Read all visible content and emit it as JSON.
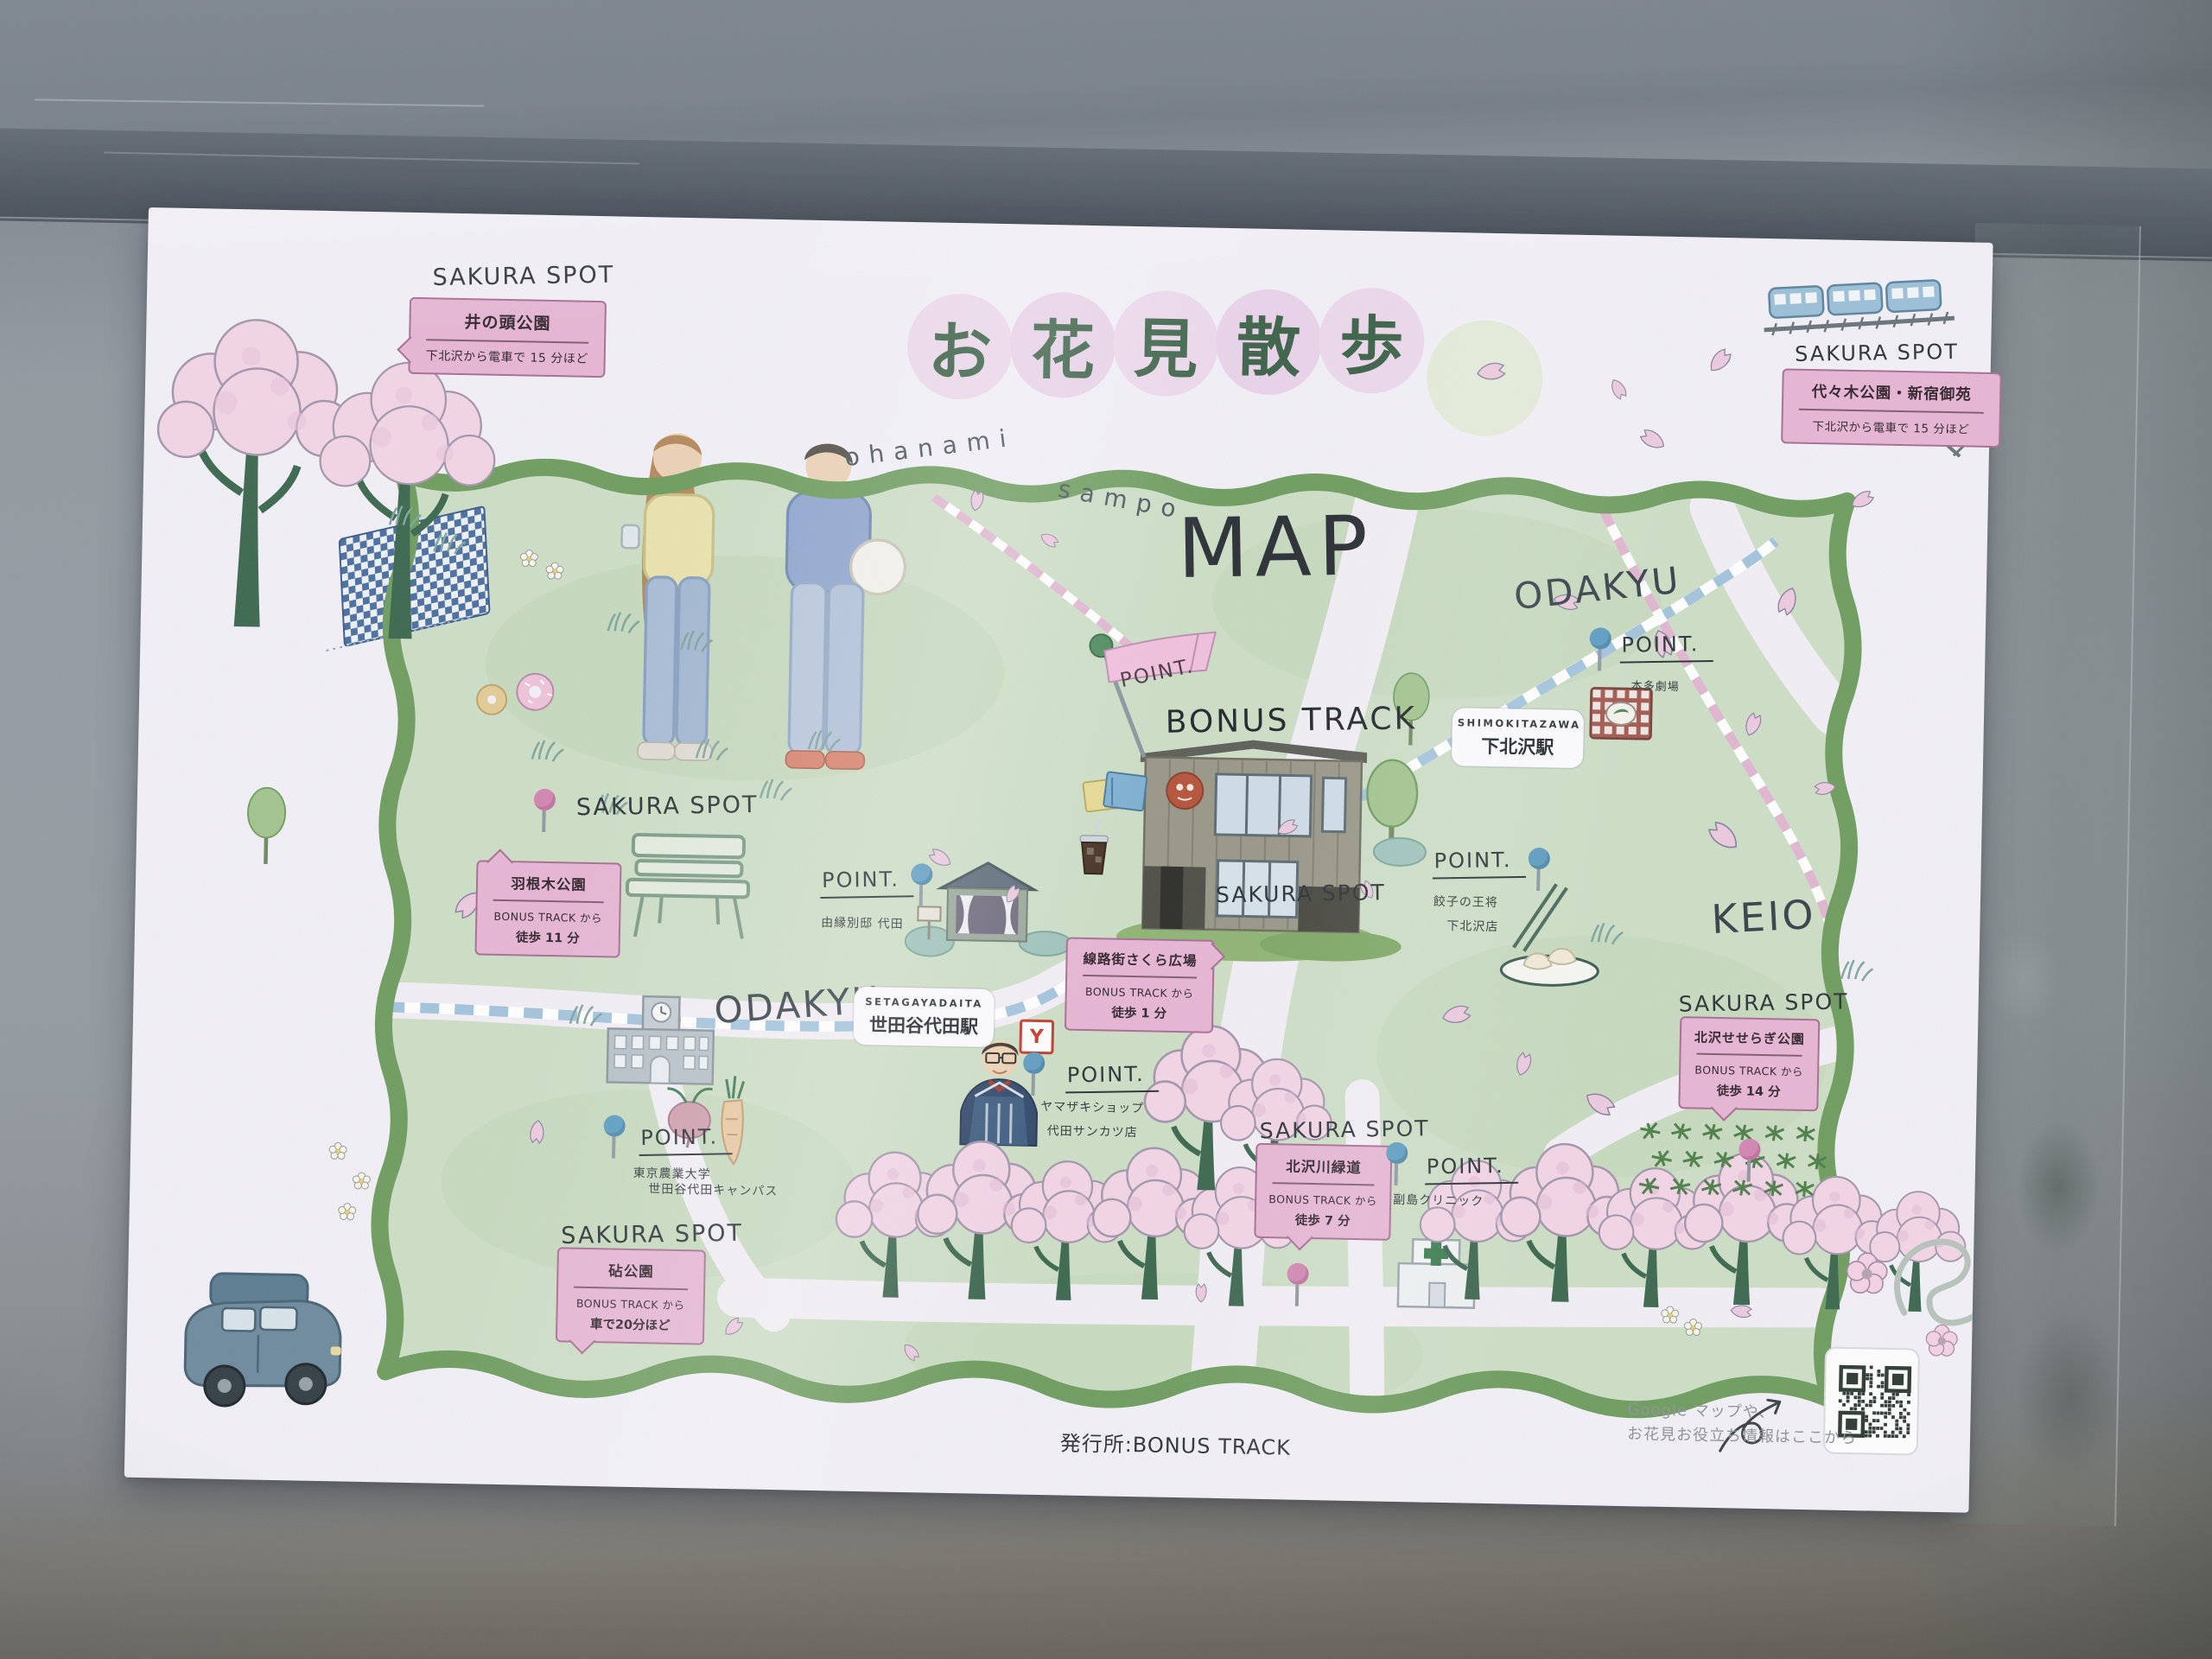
{
  "poster": {
    "header": {
      "title_chars": [
        "お",
        "花",
        "見",
        "散",
        "歩"
      ],
      "subtitle_left": "ohanami",
      "subtitle_right": "sampo",
      "map_word": "MAP"
    },
    "spots": [
      {
        "heading": "SAKURA SPOT",
        "name": "井の頭公園",
        "note": "下北沢から電車で 15 分ほど"
      },
      {
        "heading": "SAKURA SPOT",
        "name": "代々木公園・新宿御苑",
        "note": "下北沢から電車で 15 分ほど"
      },
      {
        "heading": "SAKURA SPOT",
        "name": "羽根木公園",
        "from": "BONUS TRACK から",
        "time": "徒歩 11 分"
      },
      {
        "heading": "SAKURA SPOT",
        "name": "線路街さくら広場",
        "from": "BONUS TRACK から",
        "time": "徒歩 1 分"
      },
      {
        "heading": "SAKURA SPOT",
        "name": "北沢せせらぎ公園",
        "from": "BONUS TRACK から",
        "time": "徒歩 14 分"
      },
      {
        "heading": "SAKURA SPOT",
        "name": "北沢川緑道",
        "from": "BONUS TRACK から",
        "time": "徒歩 7 分"
      },
      {
        "heading": "SAKURA SPOT",
        "name": "砧公園",
        "from": "BONUS TRACK から",
        "time": "車で20分ほど"
      }
    ],
    "points": [
      {
        "label": "POINT.",
        "line1": "由縁別邸 代田"
      },
      {
        "label": "POINT.",
        "line1": "ヤマザキショップ",
        "line2": "代田サンカツ店"
      },
      {
        "label": "POINT.",
        "line1": "本多劇場"
      },
      {
        "label": "POINT.",
        "line1": "餃子の王将",
        "line2": "下北沢店"
      },
      {
        "label": "POINT.",
        "line1": "副島クリニック"
      },
      {
        "label": "POINT.",
        "line1": "東京農業大学",
        "line2": "世田谷代田キャンパス"
      }
    ],
    "stations": [
      {
        "en": "SETAGAYADAITA",
        "jp": "世田谷代田駅"
      },
      {
        "en": "SHIMOKITAZAWA",
        "jp": "下北沢駅"
      }
    ],
    "rails": {
      "odakyu_left": "ODAKYU",
      "odakyu_right": "ODAKYU",
      "keio": "KEIO"
    },
    "bonus_track": {
      "flag_label": "POINT.",
      "name": "BONUS TRACK"
    },
    "shop_badge": "Y",
    "footer": {
      "publisher": "発行所:BONUS TRACK",
      "qr_line1": "Google マップや、",
      "qr_line2": "お花見お役立ち情報はここから"
    }
  },
  "colors": {
    "map_green": "#cddec6",
    "frame_green": "#6f9d60",
    "bubble_pink": "#e6b6d4",
    "pin_blue": "#5d9dc2",
    "pin_pink": "#d286b2",
    "title_green": "#3d6349",
    "road": "#f2eef5"
  }
}
